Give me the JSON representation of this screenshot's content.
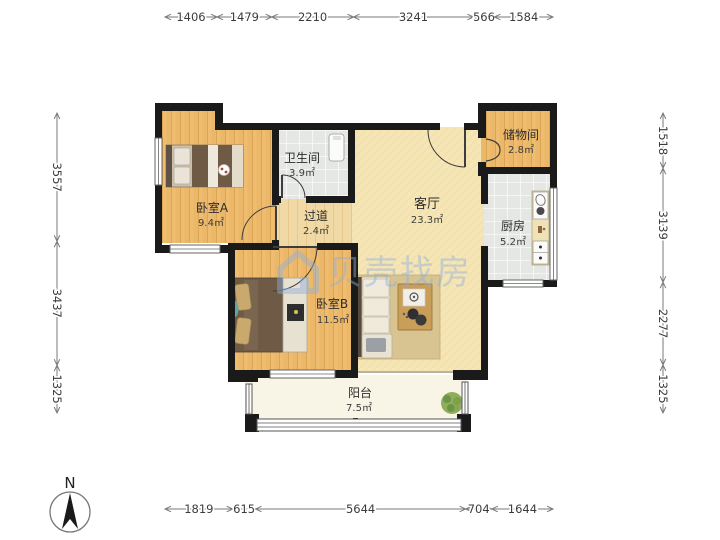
{
  "page": {
    "background": "#ffffff"
  },
  "compass": {
    "label": "N"
  },
  "watermark": {
    "text": "贝壳找房",
    "logo": "beike-house-logo",
    "color": "#8FB0DC"
  },
  "rooms": [
    {
      "id": "bedroom-a",
      "name": "卧室A",
      "area": "9.4㎡"
    },
    {
      "id": "bathroom",
      "name": "卫生间",
      "area": "3.9㎡"
    },
    {
      "id": "hallway",
      "name": "过道",
      "area": "2.4㎡"
    },
    {
      "id": "living-room",
      "name": "客厅",
      "area": "23.3㎡"
    },
    {
      "id": "storage",
      "name": "储物间",
      "area": "2.8㎡"
    },
    {
      "id": "kitchen",
      "name": "厨房",
      "area": "5.2㎡"
    },
    {
      "id": "bedroom-b",
      "name": "卧室B",
      "area": "11.5㎡"
    },
    {
      "id": "balcony",
      "name": "阳台",
      "area": "7.5㎡"
    }
  ],
  "dimensions_mm": {
    "top": [
      "1406",
      "1479",
      "2210",
      "3241",
      "566",
      "1584"
    ],
    "right": [
      "1518",
      "3139",
      "2277",
      "1325"
    ],
    "bottom": [
      "1819",
      "615",
      "5644",
      "704",
      "1644"
    ],
    "left": [
      "3557",
      "3437",
      "1325"
    ]
  },
  "colors": {
    "wall": "#1a1a1a",
    "wood_floor": "#EBB768",
    "hall_floor": "#F0D9A4",
    "tile_floor": "#E5E7E4",
    "living_floor": "#F5E5B7",
    "balcony_floor": "#F8F5E6",
    "rug": "#D8C490",
    "plant": "#8FAE5C",
    "watermark": "#8FB0DC"
  }
}
